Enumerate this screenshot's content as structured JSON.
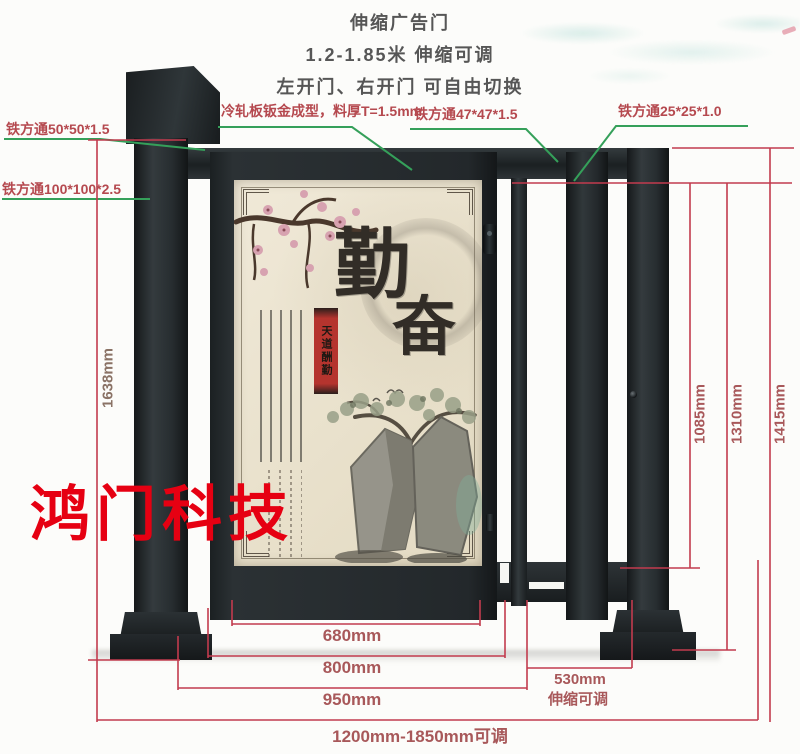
{
  "header": {
    "title": "伸缩广告门",
    "subtitle1": "1.2-1.85米 伸缩可调",
    "subtitle2": "左开门、右开门 可自由切换"
  },
  "callouts": {
    "tube_50": "铁方通50*50*1.5",
    "tube_100": "铁方通100*100*2.5",
    "cold_plate": "冷轧板钣金成型，料厚T=1.5mm",
    "tube_47": "铁方通47*47*1.5",
    "tube_25": "铁方通25*25*1.0"
  },
  "dimensions": {
    "left_total_height": "1638mm",
    "door_height": "1085mm",
    "frame_height": "1310mm",
    "post_height": "1415mm",
    "door_width": "680mm",
    "panel_width": "800mm",
    "gate_width": "950mm",
    "total_width": "1200mm-1850mm可调",
    "telescopic_width": "530mm",
    "telescopic_note": "伸缩可调"
  },
  "poster": {
    "calligraphy_char_1": "勤",
    "calligraphy_char_2": "奋",
    "seal_banner": "天道酬勤"
  },
  "watermark": "鸿门科技",
  "colors": {
    "dimension_line": "#c23b4e",
    "dimension_text": "#a8585a",
    "callout_text": "#b5494f",
    "leader_line": "#35a05a",
    "steel_dark": "#23282b",
    "poster_background": "#ece4d0",
    "watermark_red": "#e60012",
    "seal_red": "#b5342e"
  }
}
